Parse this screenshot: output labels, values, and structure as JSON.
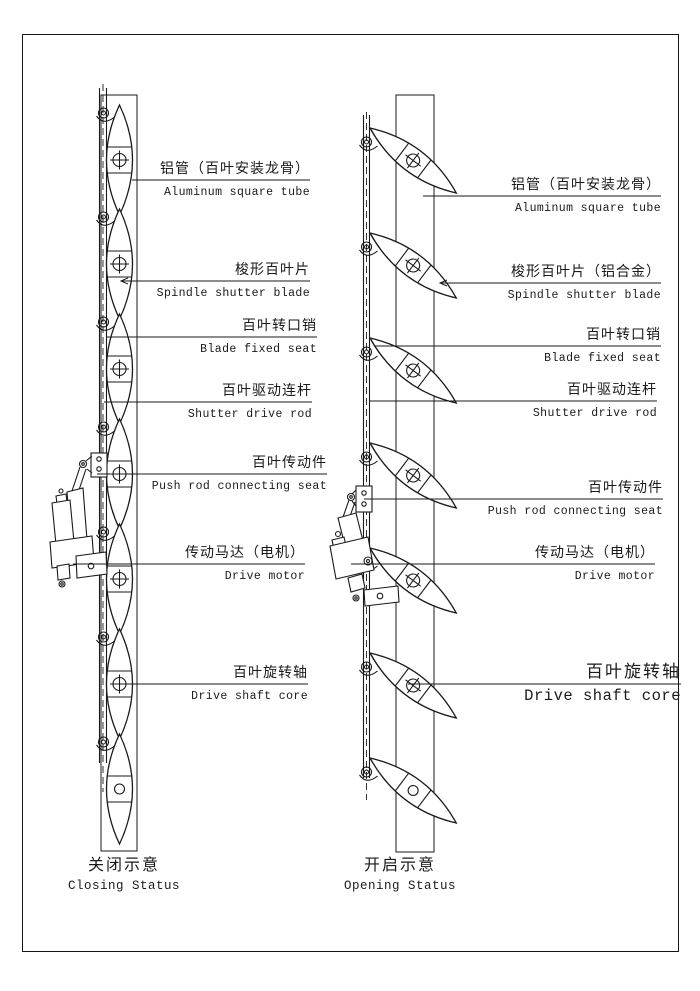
{
  "page": {
    "background": "#ffffff",
    "line_color": "#1a1a1a"
  },
  "figure": {
    "left_diagram": {
      "caption_zh": "关闭示意",
      "caption_en": "Closing Status",
      "labels": [
        {
          "zh": "铝管（百叶安装龙骨）",
          "en": "Aluminum square tube"
        },
        {
          "zh": "梭形百叶片",
          "en": "Spindle shutter blade"
        },
        {
          "zh": "百叶转口销",
          "en": "Blade fixed seat"
        },
        {
          "zh": "百叶驱动连杆",
          "en": "Shutter drive rod"
        },
        {
          "zh": "百叶传动件",
          "en": "Push rod connecting seat"
        },
        {
          "zh": "传动马达（电机）",
          "en": "Drive motor"
        },
        {
          "zh": "百叶旋转轴",
          "en": "Drive shaft core"
        }
      ]
    },
    "right_diagram": {
      "caption_zh": "开启示意",
      "caption_en": "Opening Status",
      "labels": [
        {
          "zh": "铝管（百叶安装龙骨）",
          "en": "Aluminum square tube"
        },
        {
          "zh": "梭形百叶片（铝合金）",
          "en": "Spindle shutter blade"
        },
        {
          "zh": "百叶转口销",
          "en": "Blade fixed seat"
        },
        {
          "zh": "百叶驱动连杆",
          "en": "Shutter drive rod"
        },
        {
          "zh": "百叶传动件",
          "en": "Push rod connecting seat"
        },
        {
          "zh": "传动马达（电机）",
          "en": "Drive motor"
        },
        {
          "zh": "百叶旋转轴",
          "en": "Drive shaft core"
        }
      ]
    }
  }
}
